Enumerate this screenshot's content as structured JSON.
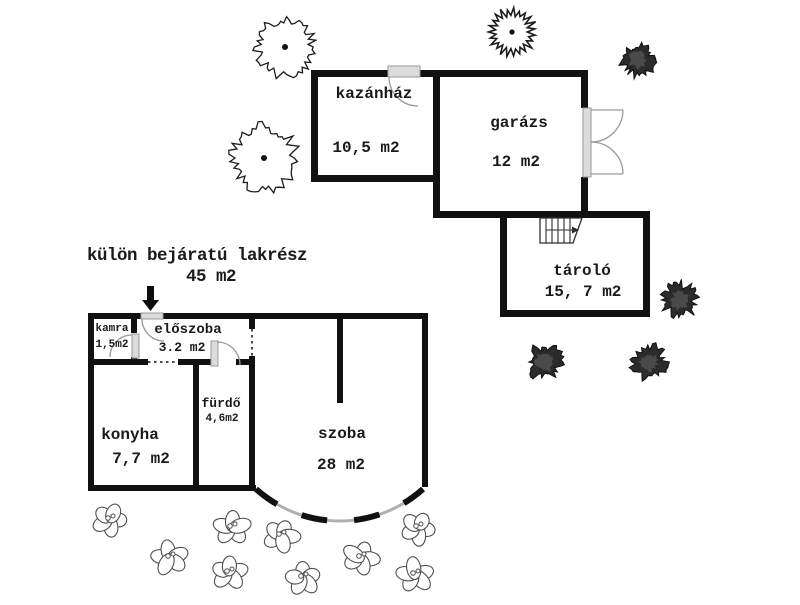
{
  "title": {
    "line1": "külön bejáratú lakrész",
    "line2": "45 m2"
  },
  "rooms": {
    "kazanhaz": {
      "name": "kazánház",
      "area": "10,5 m2"
    },
    "garazs": {
      "name": "garázs",
      "area": "12 m2"
    },
    "tarolo": {
      "name": "tároló",
      "area": "15, 7 m2"
    },
    "kamra": {
      "name": "kamra",
      "area": "1,5m2"
    },
    "eloszoba": {
      "name": "előszoba",
      "area": "3.2 m2"
    },
    "furdo": {
      "name": "fürdő",
      "area": "4,6m2"
    },
    "konyha": {
      "name": "konyha",
      "area": "7,7 m2"
    },
    "szoba": {
      "name": "szoba",
      "area": "28 m2"
    }
  },
  "colors": {
    "wall": "#111111",
    "door_fill": "#dcdcdc",
    "door_stroke": "#9a9a9a",
    "background": "#ffffff",
    "shrub_fill": "#2b2b2b"
  },
  "decor": {
    "outline_trees": [
      {
        "cx": 285,
        "cy": 47,
        "r": 33
      },
      {
        "cx": 264,
        "cy": 158,
        "r": 37
      }
    ],
    "spiky_trees": [
      {
        "cx": 512,
        "cy": 32,
        "r": 24
      }
    ],
    "dark_shrubs": [
      {
        "cx": 638,
        "cy": 60,
        "r": 20
      },
      {
        "cx": 680,
        "cy": 300,
        "r": 21
      },
      {
        "cx": 545,
        "cy": 362,
        "r": 21
      },
      {
        "cx": 649,
        "cy": 362,
        "r": 21
      }
    ],
    "flowers": [
      {
        "cx": 110,
        "cy": 520
      },
      {
        "cx": 170,
        "cy": 558
      },
      {
        "cx": 232,
        "cy": 528
      },
      {
        "cx": 229,
        "cy": 573
      },
      {
        "cx": 281,
        "cy": 536
      },
      {
        "cx": 303,
        "cy": 578
      },
      {
        "cx": 361,
        "cy": 558
      },
      {
        "cx": 418,
        "cy": 528
      },
      {
        "cx": 415,
        "cy": 575
      }
    ]
  }
}
